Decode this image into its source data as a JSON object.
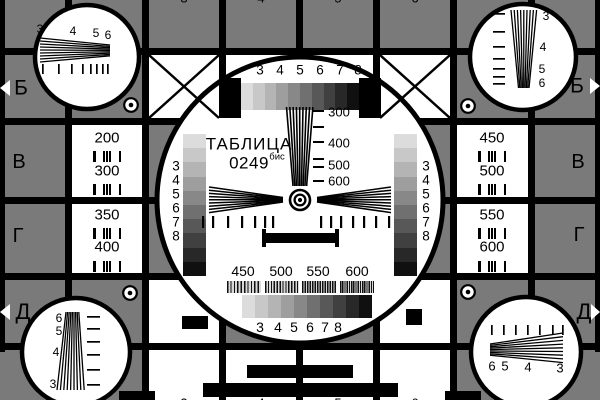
{
  "card": {
    "title": "ТАБЛИЦА",
    "code": "0249",
    "code_suffix": "бис"
  },
  "colors": {
    "background": "#7a7a7a",
    "line": "#000000",
    "white": "#ffffff",
    "grayscale_steps": [
      "#dcdcdc",
      "#c8c8c8",
      "#b4b4b4",
      "#9e9e9e",
      "#888888",
      "#707070",
      "#585858",
      "#404040",
      "#282828",
      "#101010"
    ]
  },
  "center": {
    "top_scale": [
      "3",
      "4",
      "5",
      "6",
      "7",
      "8"
    ],
    "bottom_scale": [
      "3",
      "4",
      "5",
      "6",
      "7",
      "8"
    ],
    "left_scale": [
      "3",
      "4",
      "5",
      "6",
      "7",
      "8"
    ],
    "right_scale": [
      "3",
      "4",
      "5",
      "6",
      "7",
      "8"
    ],
    "wedge_marks": [
      "300",
      "400",
      "500",
      "600"
    ],
    "burst_marks": [
      "450",
      "500",
      "550",
      "600"
    ]
  },
  "cells": {
    "left": [
      {
        "row": "В",
        "values": [
          "200",
          "300"
        ]
      },
      {
        "row": "Г",
        "values": [
          "350",
          "400"
        ]
      }
    ],
    "right": [
      {
        "row": "В",
        "values": [
          "450",
          "500"
        ]
      },
      {
        "row": "Г",
        "values": [
          "550",
          "600"
        ]
      }
    ]
  },
  "row_labels": {
    "left": [
      "Б",
      "В",
      "Г",
      "Д"
    ],
    "right": [
      "Б",
      "В",
      "Г",
      "Д"
    ]
  },
  "column_digits": {
    "top": [
      "3",
      "4",
      "5",
      "6"
    ],
    "bottom": [
      "3",
      "4",
      "5",
      "6"
    ]
  },
  "corner_wedges": {
    "top_left": [
      "3",
      "4",
      "5",
      "6"
    ],
    "top_right": [
      "3",
      "4",
      "5",
      "6"
    ],
    "bottom_left": [
      "6",
      "5",
      "4",
      "3"
    ],
    "bottom_right": [
      "6",
      "5",
      "4",
      "3"
    ]
  }
}
